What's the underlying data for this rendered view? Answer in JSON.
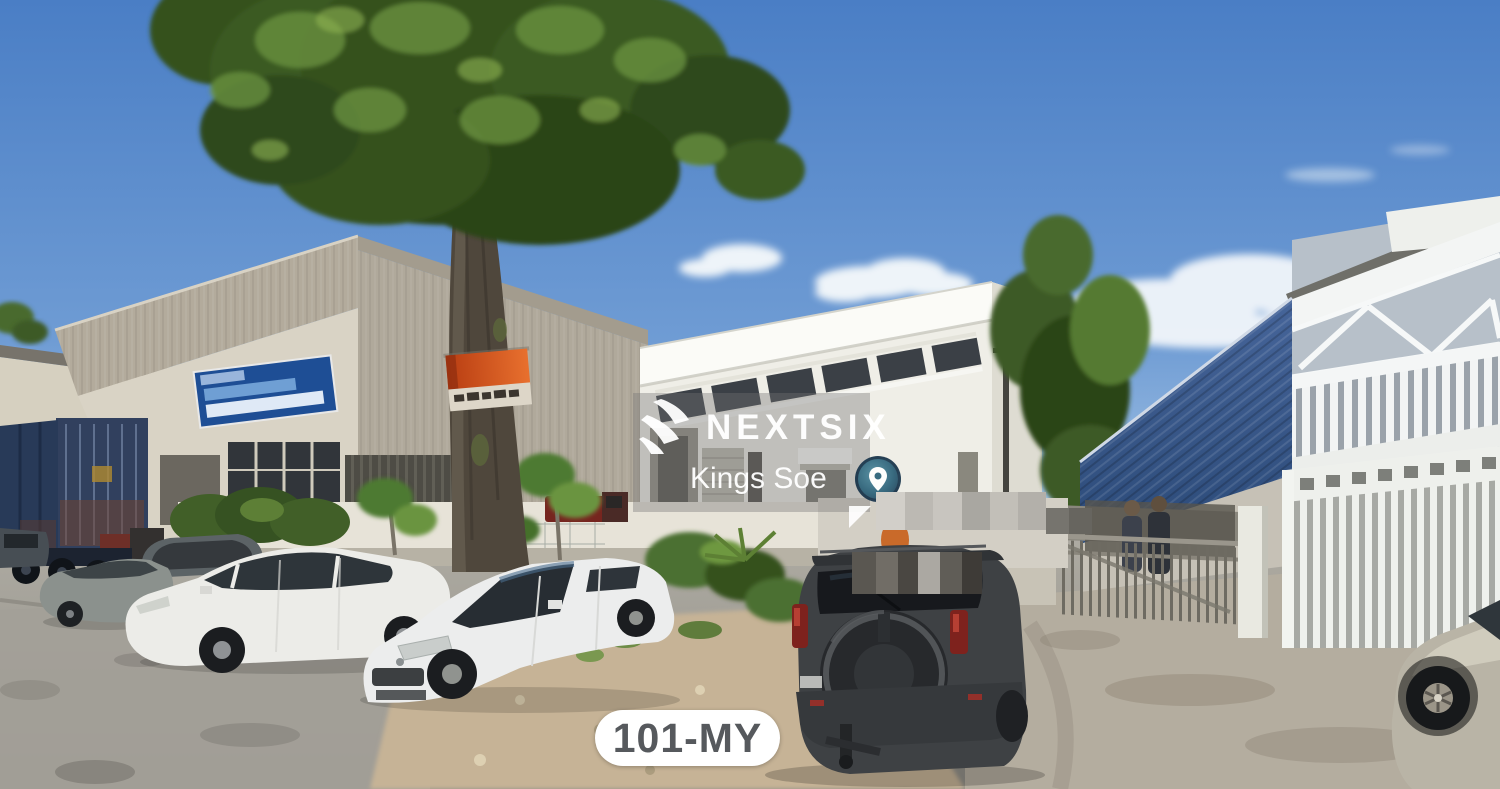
{
  "watermark": {
    "brand": "NEXTSIX",
    "agent": "Kings Soe",
    "logo_icon": "nextsix-logo-icon",
    "pin_icon": "map-pin-icon",
    "overlay_color": "#737373",
    "text_color": "#ffffff",
    "pin_colors": {
      "ring": "#17344c",
      "fill": "#2a6078",
      "glyph": "#ffffff"
    }
  },
  "location_badge": {
    "label": "101-MY",
    "background": "#ffffff",
    "text_color": "#56595d"
  },
  "scene": {
    "description": "Street-level photo of an industrial area: grey warehouse with blue signboard and shipping containers on the left, white two-storey factory in the centre, blue corrugated warehouse with white steel truss and gates on the right, large tree with a red banner sign on its trunk, parked cars (grey sedan, two white sedans, dark grey SUV with spare wheel, silver car) and two people behind a metal fence",
    "colors": {
      "sky_top": "#4a7ec5",
      "sky_horizon": "#c6daee",
      "tree_foliage": "#3a5a22",
      "tree_trunk": "#4f473c",
      "banner_top": "#d4551f",
      "banner_bottom": "#ddd6c8",
      "left_warehouse": "#b3ab9c",
      "signboard_blue": "#1e4e95",
      "container_navy": "#283a58",
      "center_building": "#efeee7",
      "blue_warehouse": "#3d5d90",
      "road": "#a9a69e",
      "dirt_patch": "#c6b396",
      "suv_body": "#3e4144",
      "white_sedan": "#ecece8"
    }
  }
}
